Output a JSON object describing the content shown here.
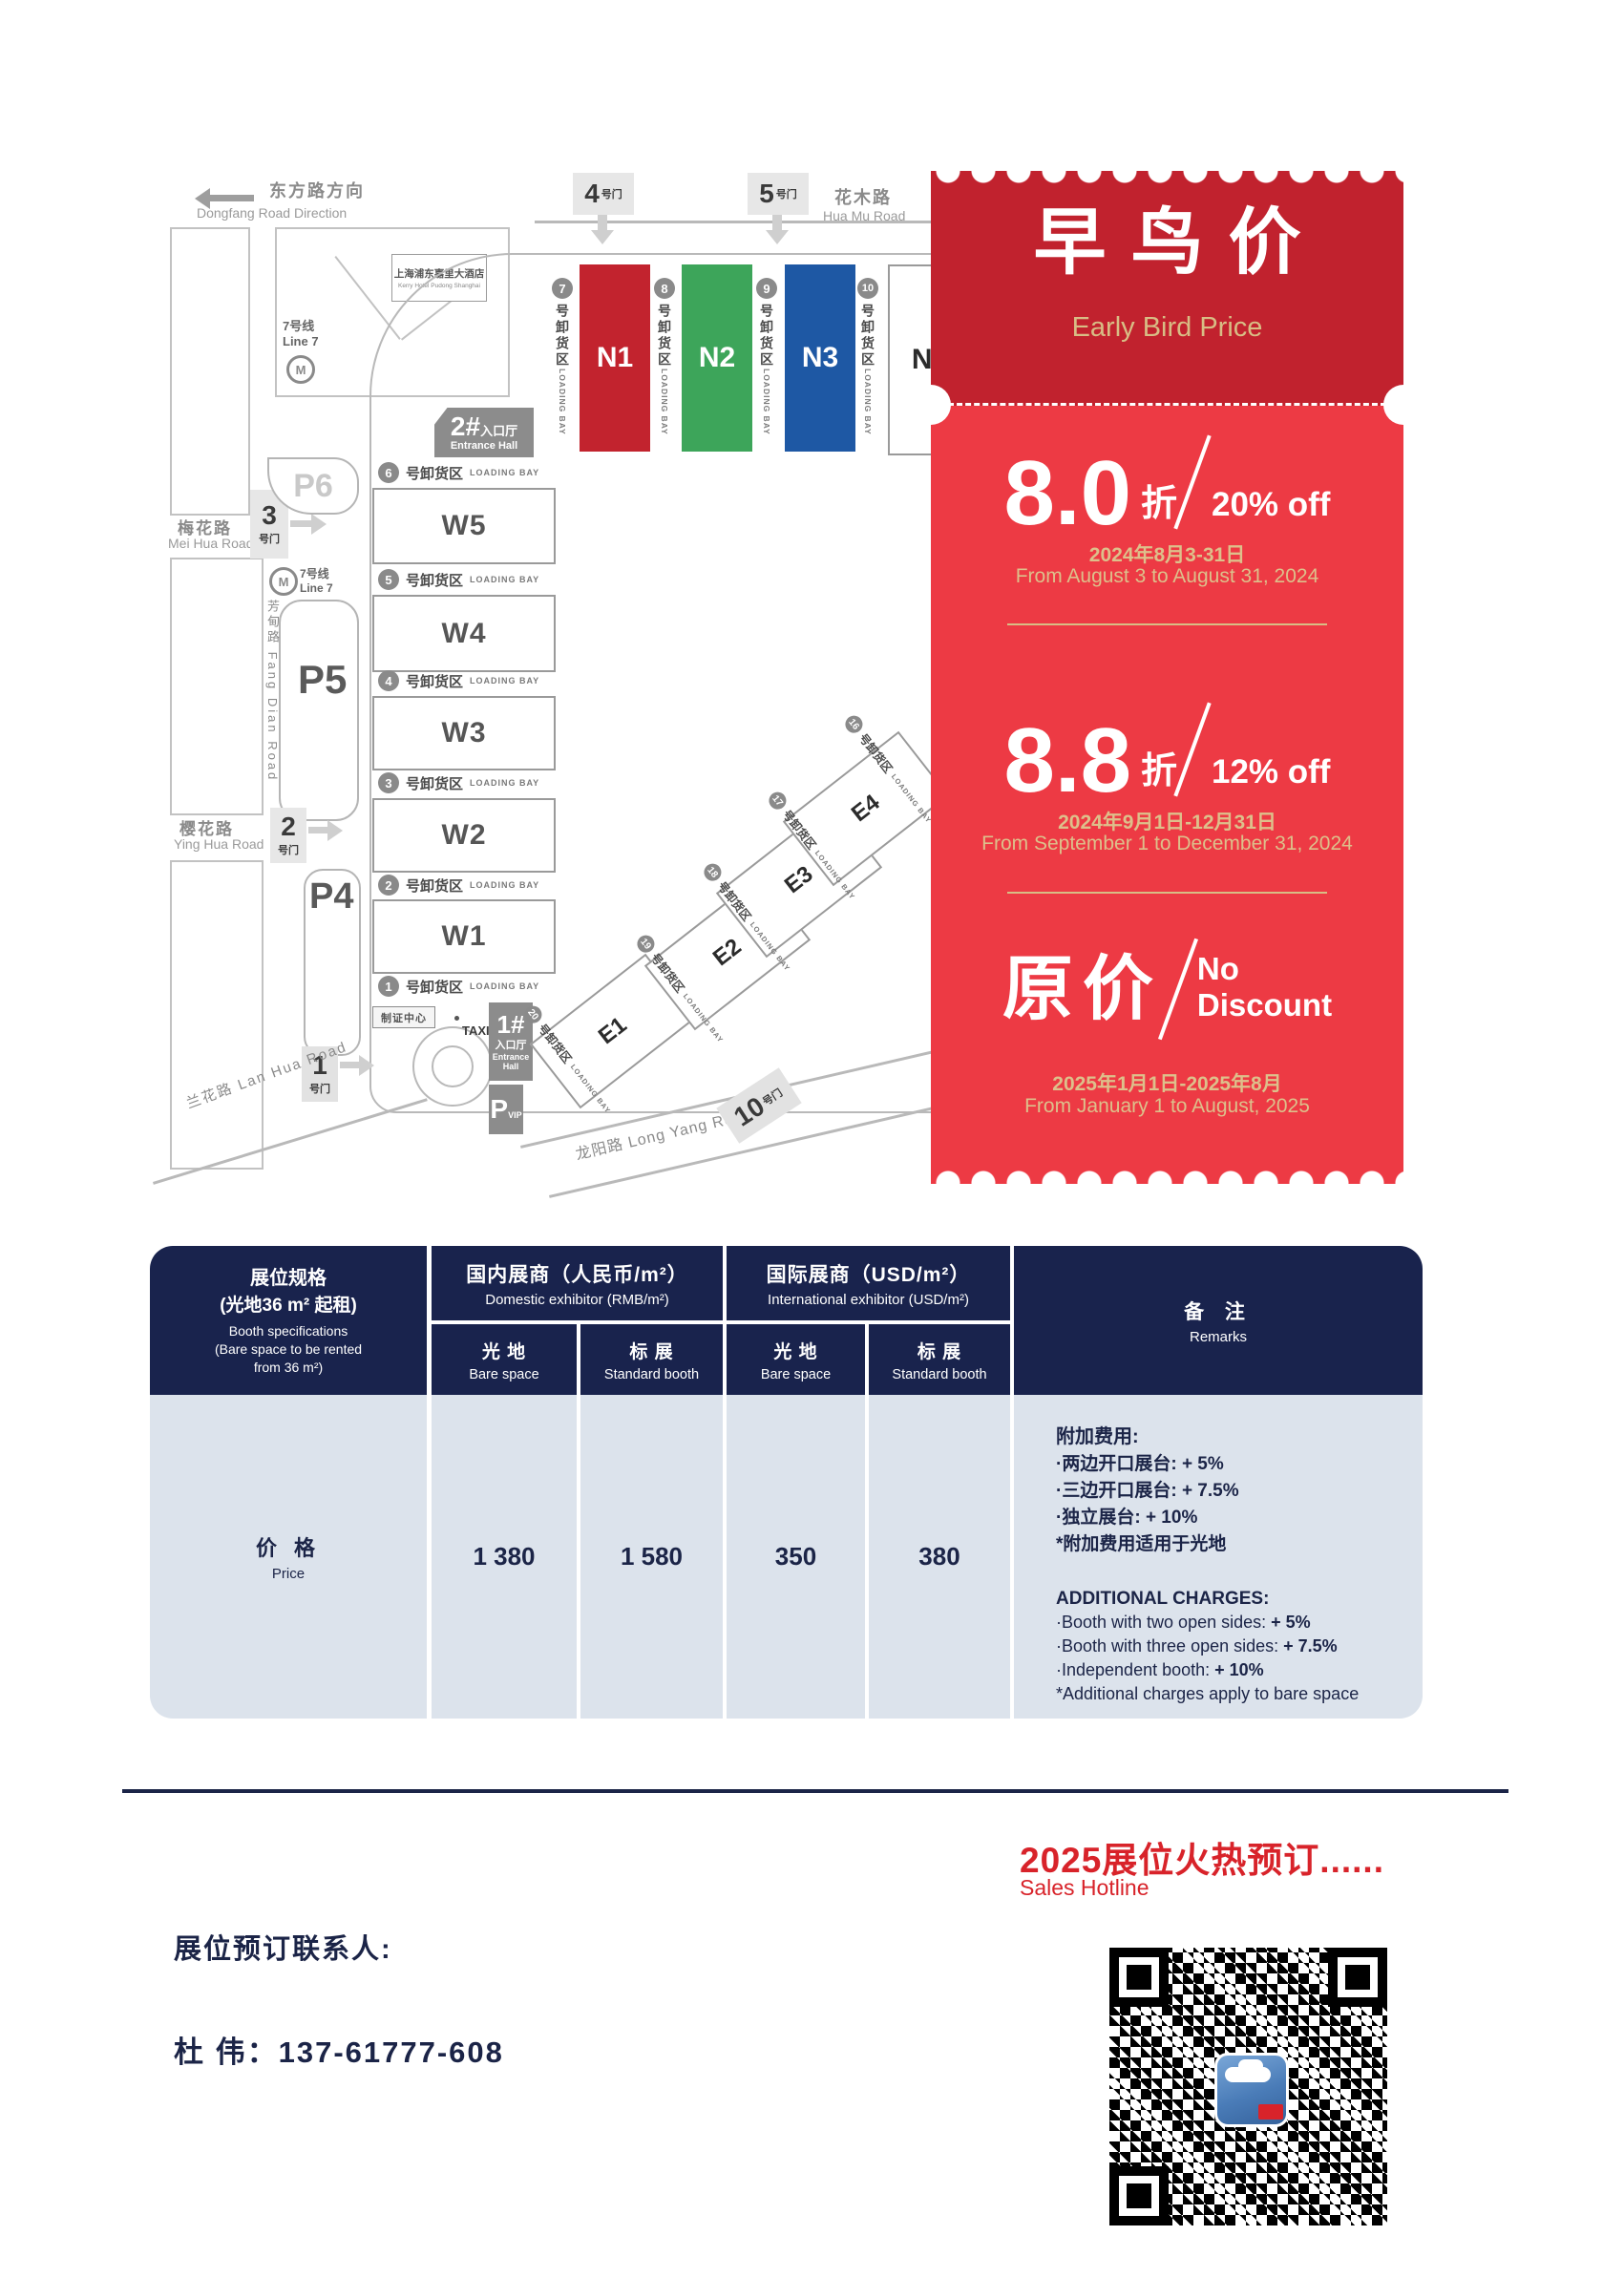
{
  "map": {
    "direction": {
      "zh": "东方路方向",
      "en": "Dongfang Road Direction"
    },
    "roads": {
      "huamu": {
        "zh": "花木路",
        "en": "Hua Mu Road"
      },
      "meihua": {
        "zh": "梅花路",
        "en": "Mei Hua Road"
      },
      "yinghua": {
        "zh": "樱花路",
        "en": "Ying Hua Road"
      },
      "fangdian": {
        "zh": "芳甸路 Fang Dian Road"
      },
      "lanhua": {
        "zh": "兰花路 Lan Hua Road"
      },
      "longyang": {
        "zh": "龙阳路 Long Yang Road"
      }
    },
    "hotel": {
      "zh": "上海浦东嘉里大酒店",
      "en": "Kerry Hotel Pudong Shanghai"
    },
    "metro": {
      "zh": "7号线",
      "en": "Line 7",
      "icon": "shanghai-metro-logo",
      "glyph": "M"
    },
    "gate_suffix": "号门",
    "gates": {
      "g1": "1",
      "g2": "2",
      "g3": "3",
      "g4": "4",
      "g5": "5",
      "g10": "10"
    },
    "parking": {
      "p4": "P4",
      "p5": "P5",
      "p6": "P6",
      "vip_p": "P",
      "vip_sub": "VIP"
    },
    "entrance1": {
      "num": "1#",
      "zh": "入口厅",
      "en": "Entrance Hall"
    },
    "entrance2": {
      "num": "2#",
      "zh": "入口厅",
      "en": "Entrance Hall"
    },
    "badge_center": "制证中心",
    "taxi": "TAXI",
    "bay_zh": "号卸货区",
    "bay_en": "LOADING BAY",
    "bays": {
      "west": [
        "6",
        "5",
        "4",
        "3",
        "2",
        "1"
      ],
      "north": [
        "7",
        "8",
        "9",
        "10"
      ],
      "east": [
        "16",
        "17",
        "18",
        "19",
        "20"
      ]
    },
    "halls": {
      "west": [
        "W5",
        "W4",
        "W3",
        "W2",
        "W1"
      ],
      "north": [
        "N1",
        "N2",
        "N3",
        "N4"
      ],
      "east": [
        "E4",
        "E3",
        "E2",
        "E1"
      ]
    }
  },
  "banner": {
    "title_zh": "早鸟价",
    "title_en": "Early Bird Price",
    "tiers": [
      {
        "value": "8.0",
        "unit": "折",
        "discount": "20% off",
        "date_zh": "2024年8月3-31日",
        "date_en": "From August 3 to August 31, 2024"
      },
      {
        "value": "8.8",
        "unit": "折",
        "discount": "12% off",
        "date_zh": "2024年9月1日-12月31日",
        "date_en": "From September 1 to December 31, 2024"
      },
      {
        "value": "原价",
        "discount_line1": "No",
        "discount_line2": "Discount",
        "date_zh": "2025年1月1日-2025年8月",
        "date_en": "From January 1 to August, 2025"
      }
    ]
  },
  "table": {
    "spec": {
      "zh1": "展位规格",
      "zh2": "(光地36 m² 起租)",
      "en1": "Booth specifications",
      "en2": "(Bare space to be rented",
      "en3": "from 36 m²)"
    },
    "group_domestic": {
      "zh": "国内展商（人民币/m²）",
      "en": "Domestic exhibitor (RMB/m²)"
    },
    "group_international": {
      "zh": "国际展商（USD/m²）",
      "en": "International exhibitor (USD/m²)"
    },
    "col_bare": {
      "zh": "光 地",
      "en": "Bare space"
    },
    "col_standard": {
      "zh": "标 展",
      "en": "Standard booth"
    },
    "remarks_head": {
      "zh": "备 注",
      "en": "Remarks"
    },
    "price_row": {
      "zh": "价 格",
      "en": "Price",
      "values": [
        "1 380",
        "1 580",
        "350",
        "380"
      ]
    },
    "remarks": {
      "zh_title": "附加费用:",
      "zh_items": [
        {
          "label": "·两边开口展台: ",
          "value": "+ 5%"
        },
        {
          "label": "·三边开口展台: ",
          "value": "+ 7.5%"
        },
        {
          "label": "·独立展台: ",
          "value": "+ 10%"
        }
      ],
      "zh_note": "*附加费用适用于光地",
      "en_title": "ADDITIONAL CHARGES:",
      "en_items": [
        {
          "label": "·Booth with two open sides: ",
          "value": "+ 5%"
        },
        {
          "label": "·Booth with three open sides: ",
          "value": "+ 7.5%"
        },
        {
          "label": "·Independent booth: ",
          "value": "+ 10%"
        }
      ],
      "en_note": "*Additional charges apply to bare space"
    }
  },
  "footer": {
    "hotline_title": "2025展位火热预订......",
    "hotline_sub": "Sales Hotline",
    "contact_label": "展位预订联系人:",
    "contact_line": "杜 伟：137-61777-608",
    "qr": "wechat-qr-code"
  },
  "colors": {
    "banner_header_red": "#c1222e",
    "banner_body_red": "#ed3a44",
    "gold": "#d8bd85",
    "navy_table": "#19234d",
    "table_cell": "#dce3ec",
    "accent_red": "#d8232a",
    "hall_n1": "#c2232e",
    "hall_n2": "#3da55a",
    "hall_n3": "#1e58a4"
  }
}
